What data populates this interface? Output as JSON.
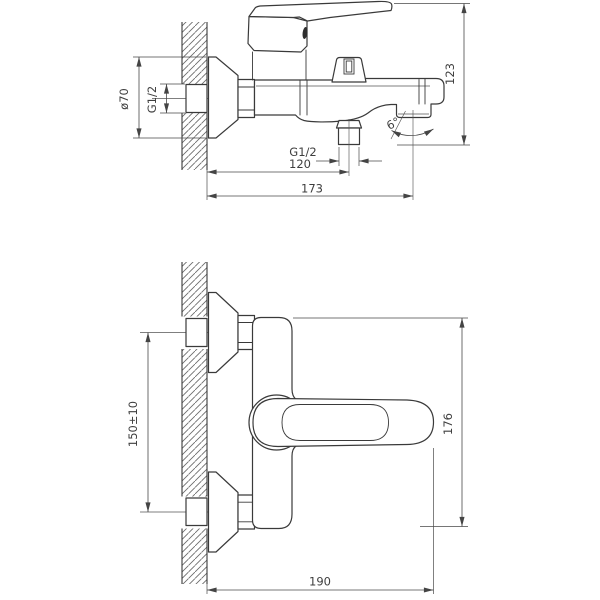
{
  "drawing": {
    "background": "#ffffff",
    "line_color": "#3a3a3a",
    "dim_color": "#4a4a4a",
    "views": {
      "side_view": {
        "name": "bath mixer side view",
        "dims": {
          "flange_diameter": "ø70",
          "inlet_thread": "G1/2",
          "overall_height": "123",
          "spout_angle": "6°",
          "shower_outlet_thread": "G1/2",
          "shower_outlet_offset": "120",
          "spout_reach": "173"
        }
      },
      "front_view": {
        "name": "bath mixer front view",
        "dims": {
          "connection_spacing": "150±10",
          "body_height": "176",
          "overall_depth": "190"
        }
      }
    }
  }
}
